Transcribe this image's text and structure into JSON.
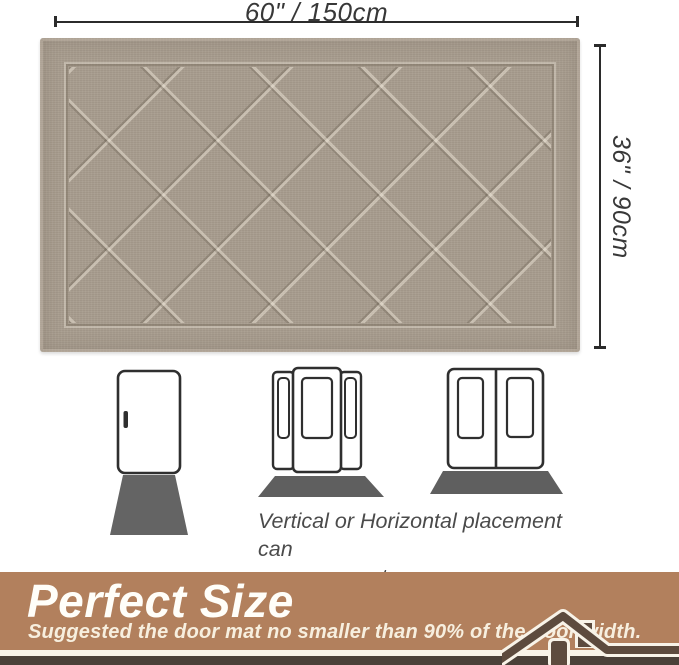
{
  "annotations": {
    "width_label": "60\" / 150cm",
    "height_label": "36\" / 90cm"
  },
  "product": {
    "item": "diamond trellis door mat",
    "pattern": "diamond lattice with plain border frame"
  },
  "placement_section": {
    "caption_line1": "Vertical or Horizontal placement can",
    "caption_line2": "save your entryway space."
  },
  "banner": {
    "title": "Perfect Size",
    "subtitle": "Suggested the door mat no smaller than 90% of the door width."
  },
  "icons": {
    "single_door": "single-door-icon",
    "door_with_sidelights": "door-with-sidelights-icon",
    "double_door": "double-door-icon",
    "vertical_mat": "vertical-mat-icon",
    "horizontal_mat": "horizontal-mat-icon",
    "house": "house-icon"
  },
  "colors": {
    "mat_base": "#a89d8f",
    "mat_ridge_light": "#eee6d8",
    "mat_groove_dark": "#60564a",
    "dimension_ink": "#2b2b2b",
    "door_outline": "#2f2f2f",
    "door_mat_gray": "#616161",
    "caption_text": "#4b4b4b",
    "banner_bg": "#b2805d",
    "banner_title": "#fffef9",
    "banner_subtitle": "#f7efdf",
    "separator_cream": "#f8f3e8",
    "bottom_band": "#4a4038",
    "house_dark": "#5d4b3e"
  }
}
